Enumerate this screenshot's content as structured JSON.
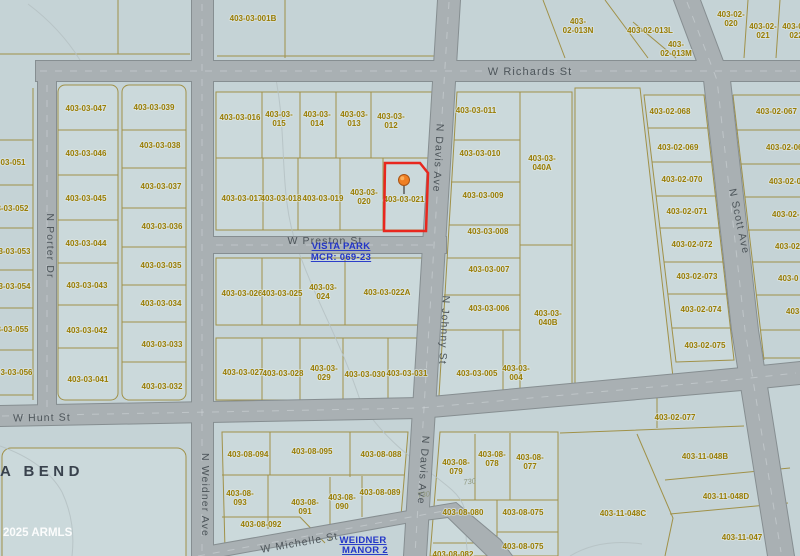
{
  "map_title": "parcel-plat-map",
  "colors": {
    "background": "#c5d3d6",
    "street_fill": "#a9b0b3",
    "parcel_line": "#a09148",
    "parcel_text": "#9a7d05",
    "highlight_red": "#e8271e",
    "subdivision_blue": "#2336c8",
    "pin_orange": "#f07f23"
  },
  "highlight": {
    "parcel_id": "403-03-021",
    "outline_color": "#e8271e",
    "marker": "map-pin"
  },
  "street_labels": [
    {
      "text": "W Richards St",
      "x": 530,
      "y": 72,
      "rot": 0,
      "size": 11
    },
    {
      "text": "N Porter Dr",
      "x": 47,
      "y": 243,
      "rot": 90
    },
    {
      "text": "N Weidner Ave",
      "x": 202,
      "y": 492,
      "rot": 90
    },
    {
      "text": "N Davis Ave",
      "x": 435,
      "y": 155,
      "rot": 93
    },
    {
      "text": "N Johnny St",
      "x": 441,
      "y": 327,
      "rot": 93
    },
    {
      "text": "N Davis Ave",
      "x": 420,
      "y": 467,
      "rot": 94
    },
    {
      "text": "N Scott Ave",
      "x": 736,
      "y": 219,
      "rot": 78
    },
    {
      "text": "W Preston St",
      "x": 325,
      "y": 241,
      "rot": 0
    },
    {
      "text": "W Hunt St",
      "x": 42,
      "y": 418,
      "rot": -1
    },
    {
      "text": "W Michelle St",
      "x": 300,
      "y": 543,
      "rot": -10
    }
  ],
  "parcels": [
    {
      "id": "403-03-051",
      "x": 5,
      "y": 162
    },
    {
      "id": "403-03-052",
      "x": 8,
      "y": 208
    },
    {
      "id": "403-03-053",
      "x": 10,
      "y": 251
    },
    {
      "id": "403-03-054",
      "x": 10,
      "y": 286
    },
    {
      "id": "403-03-055",
      "x": 8,
      "y": 329
    },
    {
      "id": "403-03-056",
      "x": 12,
      "y": 372
    },
    {
      "id": "403-03-047",
      "x": 86,
      "y": 108
    },
    {
      "id": "403-03-046",
      "x": 86,
      "y": 153
    },
    {
      "id": "403-03-045",
      "x": 86,
      "y": 198
    },
    {
      "id": "403-03-044",
      "x": 86,
      "y": 243
    },
    {
      "id": "403-03-043",
      "x": 87,
      "y": 285
    },
    {
      "id": "403-03-042",
      "x": 87,
      "y": 330
    },
    {
      "id": "403-03-041",
      "x": 88,
      "y": 379
    },
    {
      "id": "403-03-039",
      "x": 154,
      "y": 107
    },
    {
      "id": "403-03-038",
      "x": 160,
      "y": 145
    },
    {
      "id": "403-03-037",
      "x": 161,
      "y": 186
    },
    {
      "id": "403-03-036",
      "x": 162,
      "y": 226
    },
    {
      "id": "403-03-035",
      "x": 161,
      "y": 265
    },
    {
      "id": "403-03-034",
      "x": 161,
      "y": 303
    },
    {
      "id": "403-03-033",
      "x": 162,
      "y": 344
    },
    {
      "id": "403-03-032",
      "x": 162,
      "y": 386
    },
    {
      "id": "403-03-001B",
      "x": 253,
      "y": 18
    },
    {
      "id": "403-02-013N",
      "lines": [
        "403-",
        "02-013N"
      ],
      "x": 578,
      "y": 21
    },
    {
      "id": "403-02-013L",
      "x": 650,
      "y": 30
    },
    {
      "id": "403-02-013M",
      "lines": [
        "403-",
        "02-013M"
      ],
      "x": 676,
      "y": 44
    },
    {
      "id": "403-02-020",
      "lines": [
        "403-02-",
        "020"
      ],
      "x": 731,
      "y": 14
    },
    {
      "id": "403-02-021",
      "lines": [
        "403-02-",
        "021"
      ],
      "x": 763,
      "y": 26
    },
    {
      "id": "403-02-022",
      "lines": [
        "403-02-",
        "022"
      ],
      "x": 796,
      "y": 26
    },
    {
      "id": "403-03-016",
      "x": 240,
      "y": 117
    },
    {
      "id": "403-03-015",
      "lines": [
        "403-03-",
        "015"
      ],
      "x": 279,
      "y": 114
    },
    {
      "id": "403-03-014",
      "lines": [
        "403-03-",
        "014"
      ],
      "x": 317,
      "y": 114
    },
    {
      "id": "403-03-013",
      "lines": [
        "403-03-",
        "013"
      ],
      "x": 354,
      "y": 114
    },
    {
      "id": "403-03-012",
      "lines": [
        "403-03-",
        "012"
      ],
      "x": 391,
      "y": 116
    },
    {
      "id": "403-03-017",
      "x": 242,
      "y": 198
    },
    {
      "id": "403-03-018",
      "x": 281,
      "y": 198
    },
    {
      "id": "403-03-019",
      "x": 323,
      "y": 198
    },
    {
      "id": "403-03-020",
      "lines": [
        "403-03-",
        "020"
      ],
      "x": 364,
      "y": 192
    },
    {
      "id": "403-03-021",
      "x": 404,
      "y": 199
    },
    {
      "id": "403-03-011",
      "x": 476,
      "y": 110
    },
    {
      "id": "403-03-010",
      "x": 480,
      "y": 153
    },
    {
      "id": "403-03-009",
      "x": 483,
      "y": 195
    },
    {
      "id": "403-03-008",
      "x": 488,
      "y": 231
    },
    {
      "id": "403-03-007",
      "x": 489,
      "y": 269
    },
    {
      "id": "403-03-006",
      "x": 489,
      "y": 308
    },
    {
      "id": "403-03-005",
      "x": 477,
      "y": 373
    },
    {
      "id": "403-03-004",
      "lines": [
        "403-03-",
        "004"
      ],
      "x": 516,
      "y": 368
    },
    {
      "id": "403-03-040A",
      "lines": [
        "403-03-",
        "040A"
      ],
      "x": 542,
      "y": 158
    },
    {
      "id": "403-03-040B",
      "lines": [
        "403-03-",
        "040B"
      ],
      "x": 548,
      "y": 313
    },
    {
      "id": "403-03-026",
      "x": 242,
      "y": 293
    },
    {
      "id": "403-03-025",
      "x": 282,
      "y": 293
    },
    {
      "id": "403-03-024",
      "lines": [
        "403-03-",
        "024"
      ],
      "x": 323,
      "y": 287
    },
    {
      "id": "403-03-022A",
      "x": 387,
      "y": 292
    },
    {
      "id": "403-03-027",
      "x": 243,
      "y": 372
    },
    {
      "id": "403-03-028",
      "x": 283,
      "y": 373
    },
    {
      "id": "403-03-029",
      "lines": [
        "403-03-",
        "029"
      ],
      "x": 324,
      "y": 368
    },
    {
      "id": "403-03-030",
      "x": 365,
      "y": 374
    },
    {
      "id": "403-03-031",
      "x": 407,
      "y": 373
    },
    {
      "id": "403-02-068",
      "x": 670,
      "y": 111
    },
    {
      "id": "403-02-069",
      "x": 678,
      "y": 147
    },
    {
      "id": "403-02-070",
      "x": 682,
      "y": 179
    },
    {
      "id": "403-02-071",
      "x": 687,
      "y": 211
    },
    {
      "id": "403-02-072",
      "x": 692,
      "y": 244
    },
    {
      "id": "403-02-073",
      "x": 697,
      "y": 276
    },
    {
      "id": "403-02-074",
      "x": 701,
      "y": 309
    },
    {
      "id": "403-02-075",
      "x": 705,
      "y": 345
    },
    {
      "id": "403-02-077",
      "x": 675,
      "y": 417
    },
    {
      "id": "403-02-067",
      "x": 756,
      "y": 111,
      "anchor": "start"
    },
    {
      "id": "403-02-06",
      "x": 766,
      "y": 147,
      "anchor": "start"
    },
    {
      "id": "403-02-06",
      "x": 769,
      "y": 181,
      "anchor": "start"
    },
    {
      "id": "403-02-0",
      "x": 772,
      "y": 214,
      "anchor": "start"
    },
    {
      "id": "403-02",
      "x": 775,
      "y": 246,
      "anchor": "start"
    },
    {
      "id": "403-0",
      "x": 778,
      "y": 278,
      "anchor": "start"
    },
    {
      "id": "403-",
      "x": 786,
      "y": 311,
      "anchor": "start"
    },
    {
      "id": "403-08-094",
      "x": 248,
      "y": 454
    },
    {
      "id": "403-08-095",
      "x": 312,
      "y": 451
    },
    {
      "id": "403-08-088",
      "x": 381,
      "y": 454
    },
    {
      "id": "403-08-093",
      "lines": [
        "403-08-",
        "093"
      ],
      "x": 240,
      "y": 493
    },
    {
      "id": "403-08-091",
      "lines": [
        "403-08-",
        "091"
      ],
      "x": 305,
      "y": 502
    },
    {
      "id": "403-08-090",
      "lines": [
        "403-08-",
        "090"
      ],
      "x": 342,
      "y": 497
    },
    {
      "id": "403-08-089",
      "x": 380,
      "y": 492
    },
    {
      "id": "403-08-092",
      "x": 261,
      "y": 524
    },
    {
      "id": "403-08-079",
      "lines": [
        "403-08-",
        "079"
      ],
      "x": 456,
      "y": 462
    },
    {
      "id": "403-08-078",
      "lines": [
        "403-08-",
        "078"
      ],
      "x": 492,
      "y": 454
    },
    {
      "id": "403-08-077",
      "lines": [
        "403-08-",
        "077"
      ],
      "x": 530,
      "y": 457
    },
    {
      "id": "403-08-080",
      "x": 463,
      "y": 512
    },
    {
      "id": "403-08-075",
      "x": 523,
      "y": 512
    },
    {
      "id": "403-08-075",
      "x": 523,
      "y": 546
    },
    {
      "id": "403-08-082",
      "x": 453,
      "y": 554
    },
    {
      "id": "403-11-048C",
      "x": 623,
      "y": 513
    },
    {
      "id": "403-11-048B",
      "x": 705,
      "y": 456
    },
    {
      "id": "403-11-048D",
      "x": 726,
      "y": 496
    },
    {
      "id": "403-11-047",
      "x": 742,
      "y": 537
    }
  ],
  "subdivision_labels": [
    {
      "text": "VISTA PARK",
      "x": 341,
      "y": 246
    },
    {
      "text": "MCR: 069-23",
      "x": 341,
      "y": 257
    },
    {
      "text": "WEIDNER",
      "x": 363,
      "y": 540
    },
    {
      "text": "MANOR 2",
      "x": 365,
      "y": 550
    }
  ],
  "survey_notes": [
    {
      "text": "730",
      "x": 470,
      "y": 481,
      "rot": -8
    },
    {
      "text": "730",
      "x": 424,
      "y": 494,
      "rot": -8
    }
  ],
  "place_label": {
    "text": "A BEND"
  },
  "watermark": {
    "text": "2025 ARMLS"
  }
}
